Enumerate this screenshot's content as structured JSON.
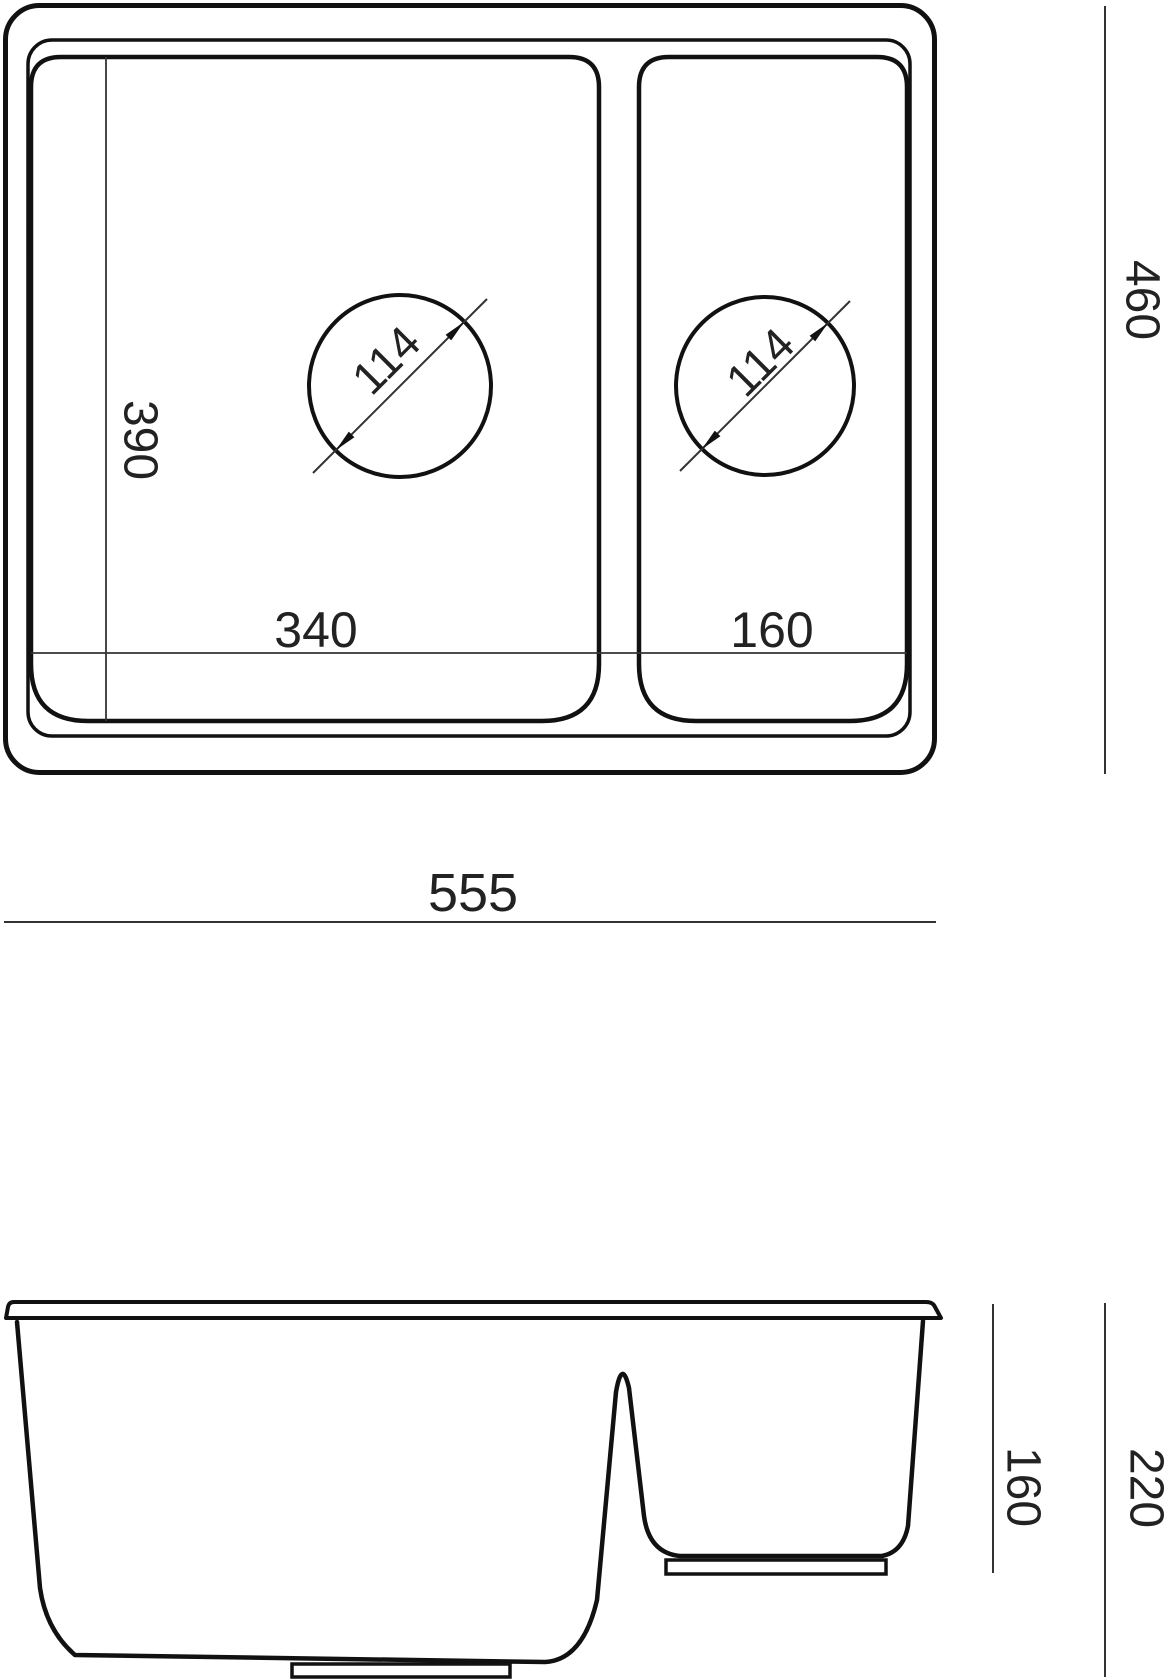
{
  "diagram": {
    "kind": "technical-drawing",
    "subject": "one-and-a-half bowl kitchen sink, top view and front section view",
    "colors": {
      "line": "#111111",
      "thin_line": "#333333",
      "text": "#222222",
      "background": "#ffffff"
    },
    "top_view": {
      "overall_width": "555",
      "overall_depth": "460",
      "main_bowl_width": "340",
      "main_bowl_depth": "390",
      "small_bowl_width": "160",
      "main_drain_diameter": "114",
      "small_drain_diameter": "114"
    },
    "side_view": {
      "overall_height": "220",
      "small_bowl_depth": "160"
    }
  }
}
